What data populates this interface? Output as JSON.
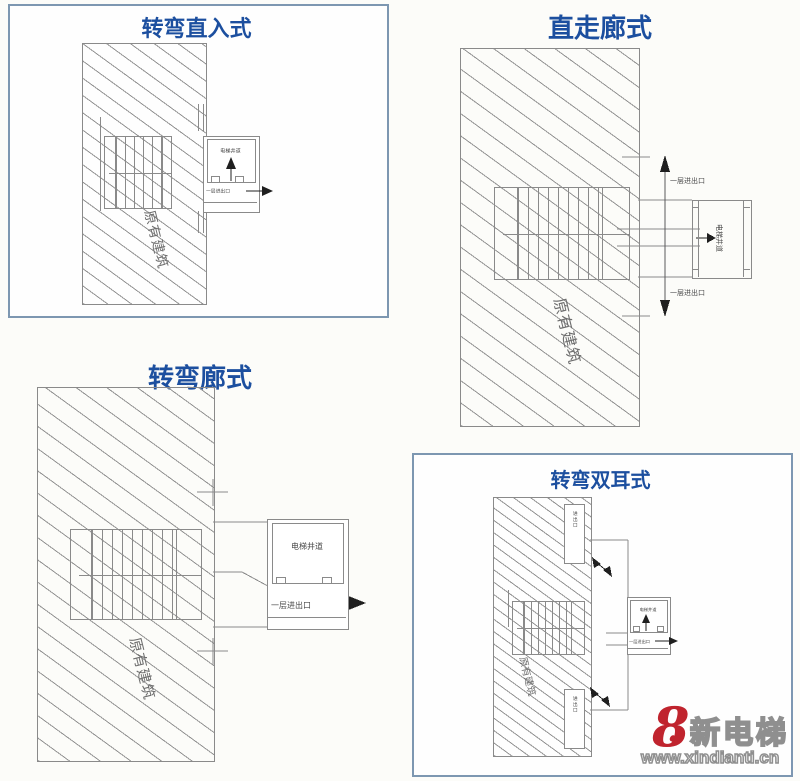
{
  "page": {
    "background": "#fcfcf9"
  },
  "colors": {
    "title_blue": "#1c4f9f",
    "panel_border": "#7d97b1",
    "line_gray": "#8a8a8a",
    "building_label_gray": "#6e6e6e",
    "arrow_black": "#1f1f1f",
    "logo_red": "#c0242e",
    "logo_outline_gray": "#8f8f8f"
  },
  "panels": {
    "turn_direct": {
      "title": "转弯直入式",
      "building_label": "原有建筑",
      "shaft_label": "电梯井道",
      "exit_label": "一层进出口"
    },
    "straight_corridor": {
      "title": "直走廊式",
      "building_label": "原有建筑",
      "shaft_label": "电梯井道",
      "exit_top_label": "一层进出口",
      "exit_bottom_label": "一层进出口"
    },
    "turn_corridor": {
      "title": "转弯廊式",
      "building_label": "原有建筑",
      "shaft_label": "电梯井道",
      "exit_label": "一层进出口"
    },
    "turn_double_ear": {
      "title": "转弯双耳式",
      "building_label": "原有建筑",
      "shaft_label": "电梯井道",
      "exit_label": "一层进出口",
      "ear_top_label": "进出口",
      "ear_bottom_label": "进出口"
    }
  },
  "watermark": {
    "icon_glyph": "8",
    "heart_glyph": "❤",
    "brand": "新电梯",
    "url": "www.xindianti.cn"
  }
}
